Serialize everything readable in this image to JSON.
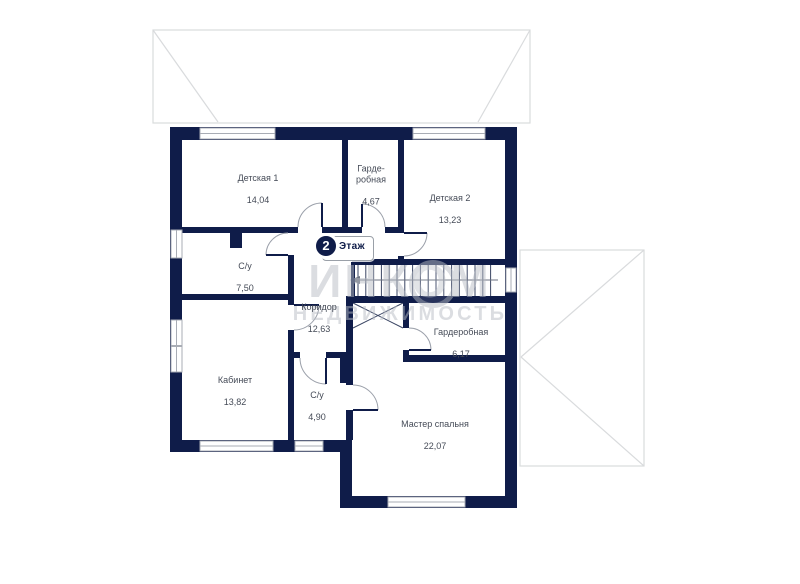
{
  "floor_badge": {
    "number": "2",
    "label": "Этаж"
  },
  "rooms": [
    {
      "id": "detskaya-1",
      "name": "Детская 1",
      "area": "14,04"
    },
    {
      "id": "garderobnaya-top",
      "name": "Гарде-\nробная",
      "area": "4,67"
    },
    {
      "id": "detskaya-2",
      "name": "Детская 2",
      "area": "13,23"
    },
    {
      "id": "su-top",
      "name": "С/у",
      "area": "7,50"
    },
    {
      "id": "koridor",
      "name": "Коридор",
      "area": "12,63"
    },
    {
      "id": "garderobnaya-master",
      "name": "Гардеробная",
      "area": "6,17"
    },
    {
      "id": "kabinet",
      "name": "Кабинет",
      "area": "13,82"
    },
    {
      "id": "su-bottom",
      "name": "С/у",
      "area": "4,90"
    },
    {
      "id": "master",
      "name": "Мастер спальня",
      "area": "22,07"
    }
  ],
  "watermark": {
    "brand": "ИНКОМ",
    "subtitle": "НЕДВИЖИМОСТЬ"
  },
  "colors": {
    "wall": "#0f1c49",
    "room_label": "#454b57",
    "roof_line": "#d9dbdd",
    "window_frame": "#a9adb5",
    "door_arc": "#9ba0aa",
    "stair_tread": "#3a4563",
    "stair_arrow": "#6b7280",
    "watermark": "#b9bdc5",
    "badge_border": "#9aa0a8"
  }
}
